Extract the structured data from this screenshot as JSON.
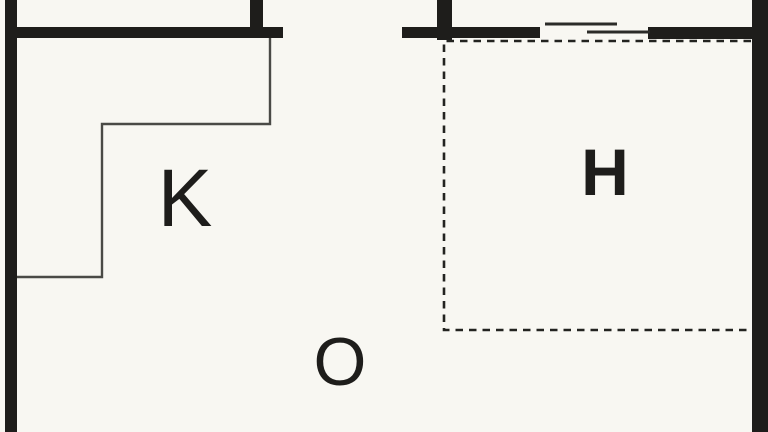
{
  "floor_plan": {
    "description": "Partial apartment floor plan, cropped at top and bottom",
    "rooms": [
      {
        "id": "k",
        "label": "K"
      },
      {
        "id": "o",
        "label": "O"
      },
      {
        "id": "h",
        "label": "H"
      }
    ],
    "features": {
      "counter": "L-shaped thin counter outline in room K",
      "sliding_door": "overlapping thin line pair in top-right wall opening",
      "dashed_zone": "dashed rectangle bounding room H"
    }
  },
  "colors": {
    "background": "#f8f7f2",
    "wall": "#1e1d1b",
    "thin_line": "#4a4a46",
    "door_line": "#2b2b28",
    "dashed_line": "#232320",
    "label_text": "#1e1d1b"
  }
}
